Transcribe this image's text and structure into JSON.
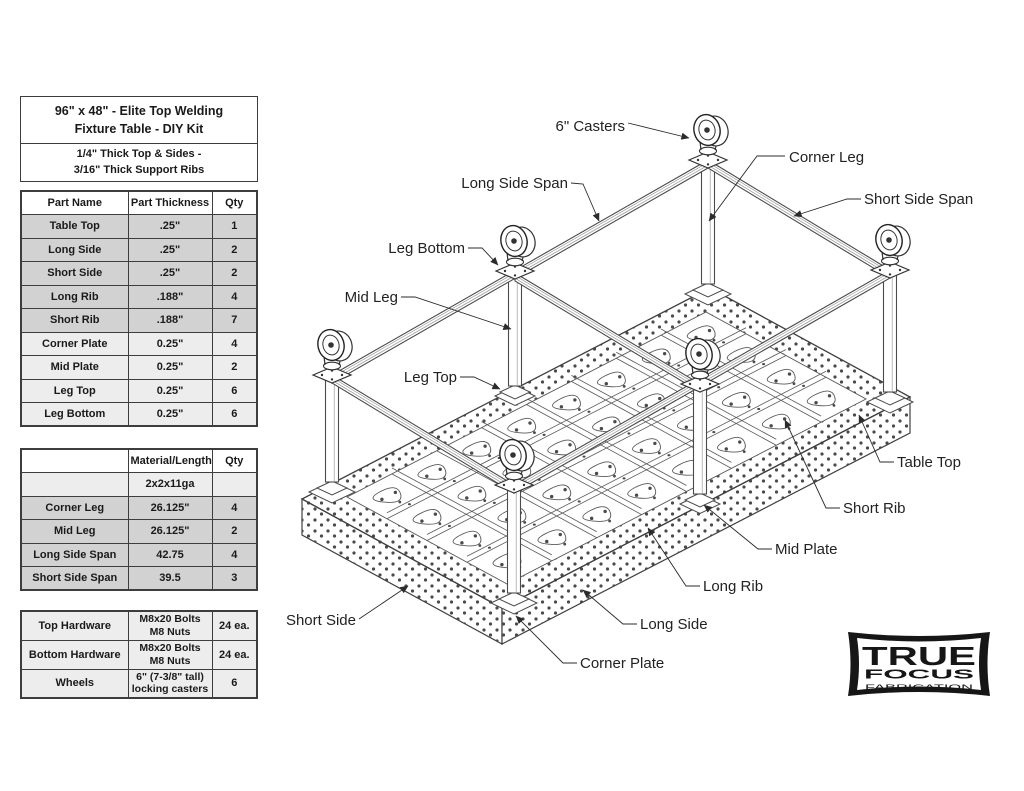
{
  "title_block": {
    "line1": "96\" x 48\" - Elite Top Welding",
    "line2": "Fixture Table - DIY Kit",
    "sub1": "1/4\" Thick Top & Sides -",
    "sub2": "3/16\" Thick Support Ribs"
  },
  "parts_table": {
    "headers": [
      "Part Name",
      "Part Thickness",
      "Qty"
    ],
    "rows": [
      [
        "Table Top",
        ".25\"",
        "1"
      ],
      [
        "Long Side",
        ".25\"",
        "2"
      ],
      [
        "Short Side",
        ".25\"",
        "2"
      ],
      [
        "Long Rib",
        ".188\"",
        "4"
      ],
      [
        "Short Rib",
        ".188\"",
        "7"
      ],
      [
        "Corner Plate",
        "0.25\"",
        "4"
      ],
      [
        "Mid Plate",
        "0.25\"",
        "2"
      ],
      [
        "Leg Top",
        "0.25\"",
        "6"
      ],
      [
        "Leg Bottom",
        "0.25\"",
        "6"
      ]
    ]
  },
  "materials_table": {
    "headers": [
      "",
      "Material/Length",
      "Qty"
    ],
    "rows": [
      [
        "",
        "2x2x11ga",
        ""
      ],
      [
        "Corner Leg",
        "26.125\"",
        "4"
      ],
      [
        "Mid Leg",
        "26.125\"",
        "2"
      ],
      [
        "Long Side Span",
        "42.75",
        "4"
      ],
      [
        "Short Side Span",
        "39.5",
        "3"
      ]
    ]
  },
  "hardware_table": {
    "rows": [
      [
        "Top Hardware",
        [
          "M8x20 Bolts",
          "M8 Nuts"
        ],
        "24 ea."
      ],
      [
        "Bottom Hardware",
        [
          "M8x20 Bolts",
          "M8 Nuts"
        ],
        "24 ea."
      ],
      [
        "Wheels",
        [
          "6\" (7-3/8\" tall)",
          "locking casters"
        ],
        "6"
      ]
    ]
  },
  "diagram": {
    "labels": [
      {
        "text": "6\" Casters"
      },
      {
        "text": "Corner Leg"
      },
      {
        "text": "Long Side Span"
      },
      {
        "text": "Short Side Span"
      },
      {
        "text": "Leg Bottom"
      },
      {
        "text": "Mid Leg"
      },
      {
        "text": "Leg Top"
      },
      {
        "text": "Table Top"
      },
      {
        "text": "Short Rib"
      },
      {
        "text": "Mid Plate"
      },
      {
        "text": "Long Rib"
      },
      {
        "text": "Long Side"
      },
      {
        "text": "Short Side"
      },
      {
        "text": "Corner Plate"
      }
    ]
  },
  "logo": {
    "line1": "TRUE",
    "line2": "FOCUS",
    "line3": "FABRICATION"
  },
  "colors": {
    "line": "#3f3f3f",
    "row_gray": "#d2d2d2",
    "row_light": "#ededed",
    "ink": "#1a1a1a"
  }
}
